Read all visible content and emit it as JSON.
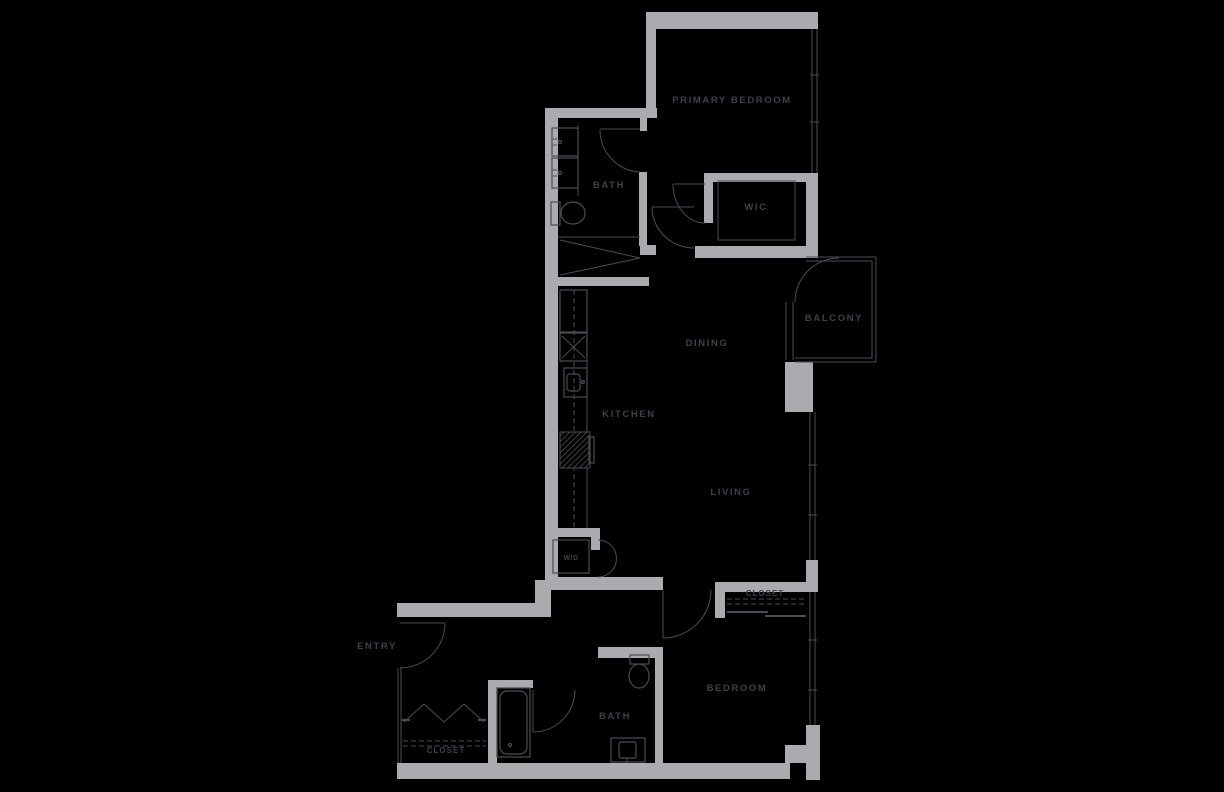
{
  "plan": {
    "type": "apartment-floor-plan",
    "colors": {
      "background": "#000000",
      "wall_fill": "#a9abae",
      "line": "#4c4d50",
      "label_text": "#404144"
    },
    "rooms": {
      "primary_bedroom": "PRIMARY BEDROOM",
      "bath_upper": "BATH",
      "wic": "WIC",
      "balcony": "BALCONY",
      "dining": "DINING",
      "kitchen": "KITCHEN",
      "living": "LIVING",
      "wd": "W/D",
      "entry": "ENTRY",
      "closet_entry": "CLOSET",
      "bath_lower": "BATH",
      "bedroom": "BEDROOM",
      "closet_bedroom": "CLOSET"
    },
    "fixtures": [
      "double-vanity",
      "toilet",
      "shower",
      "refrigerator",
      "cooktop",
      "kitchen-sink",
      "oven",
      "washer-dryer",
      "bathtub",
      "toilet",
      "bath-sink"
    ]
  }
}
